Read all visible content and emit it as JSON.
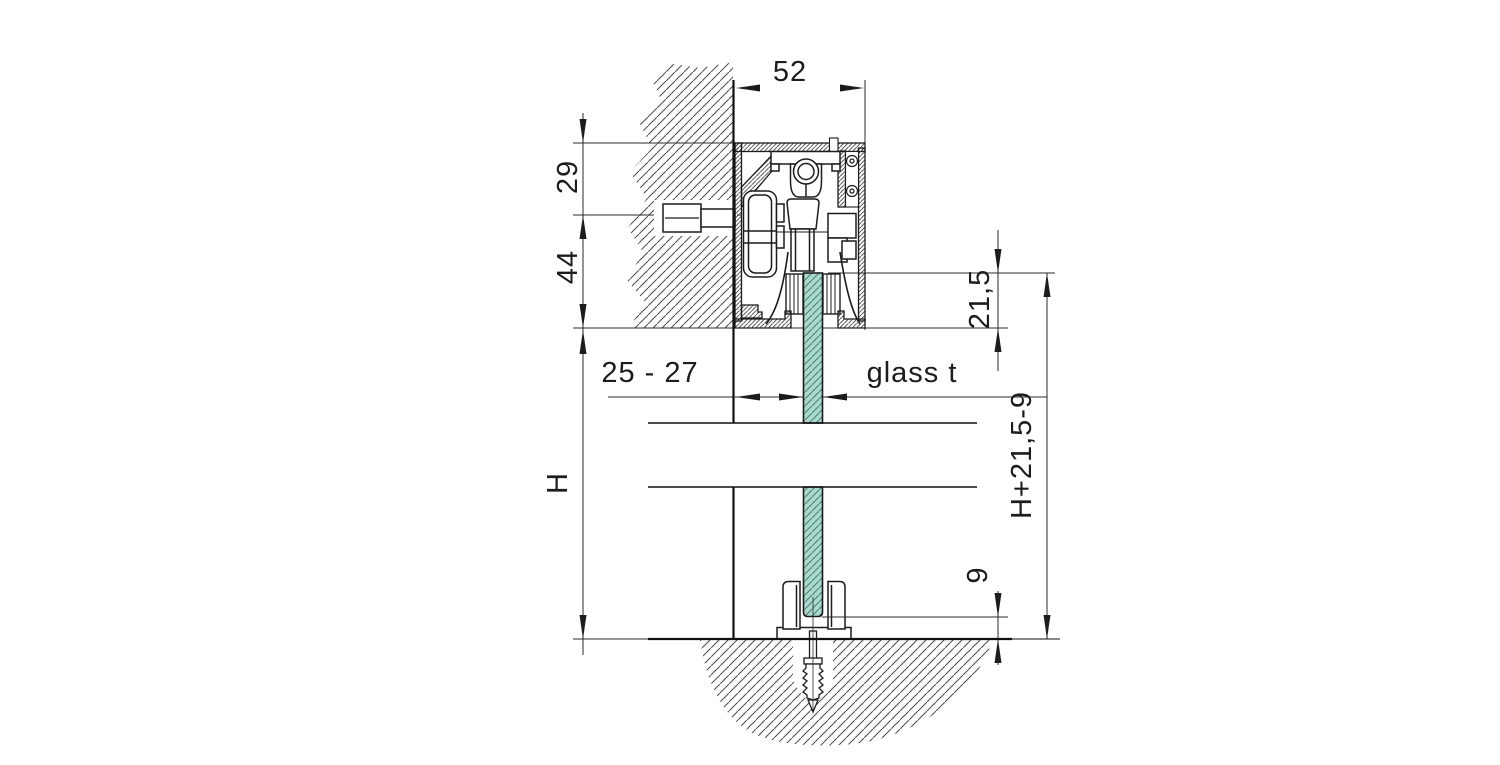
{
  "drawing": {
    "title": "sliding-door-track-cross-section",
    "labels": {
      "profile_width": "52",
      "top_offset": "29",
      "profile_height": "44",
      "wall_to_glass": "25 - 27",
      "glass_thickness": "glass t",
      "glass_engagement_top": "21,5",
      "opening_height": "H",
      "glass_panel_height": "H+21,5-9",
      "bottom_gap": "9"
    },
    "colors": {
      "glass_fill": "#a6dbcf",
      "glass_hatch": "#5c7a72",
      "line": "#1c1c1c",
      "hatch": "#4d4d4d"
    }
  }
}
